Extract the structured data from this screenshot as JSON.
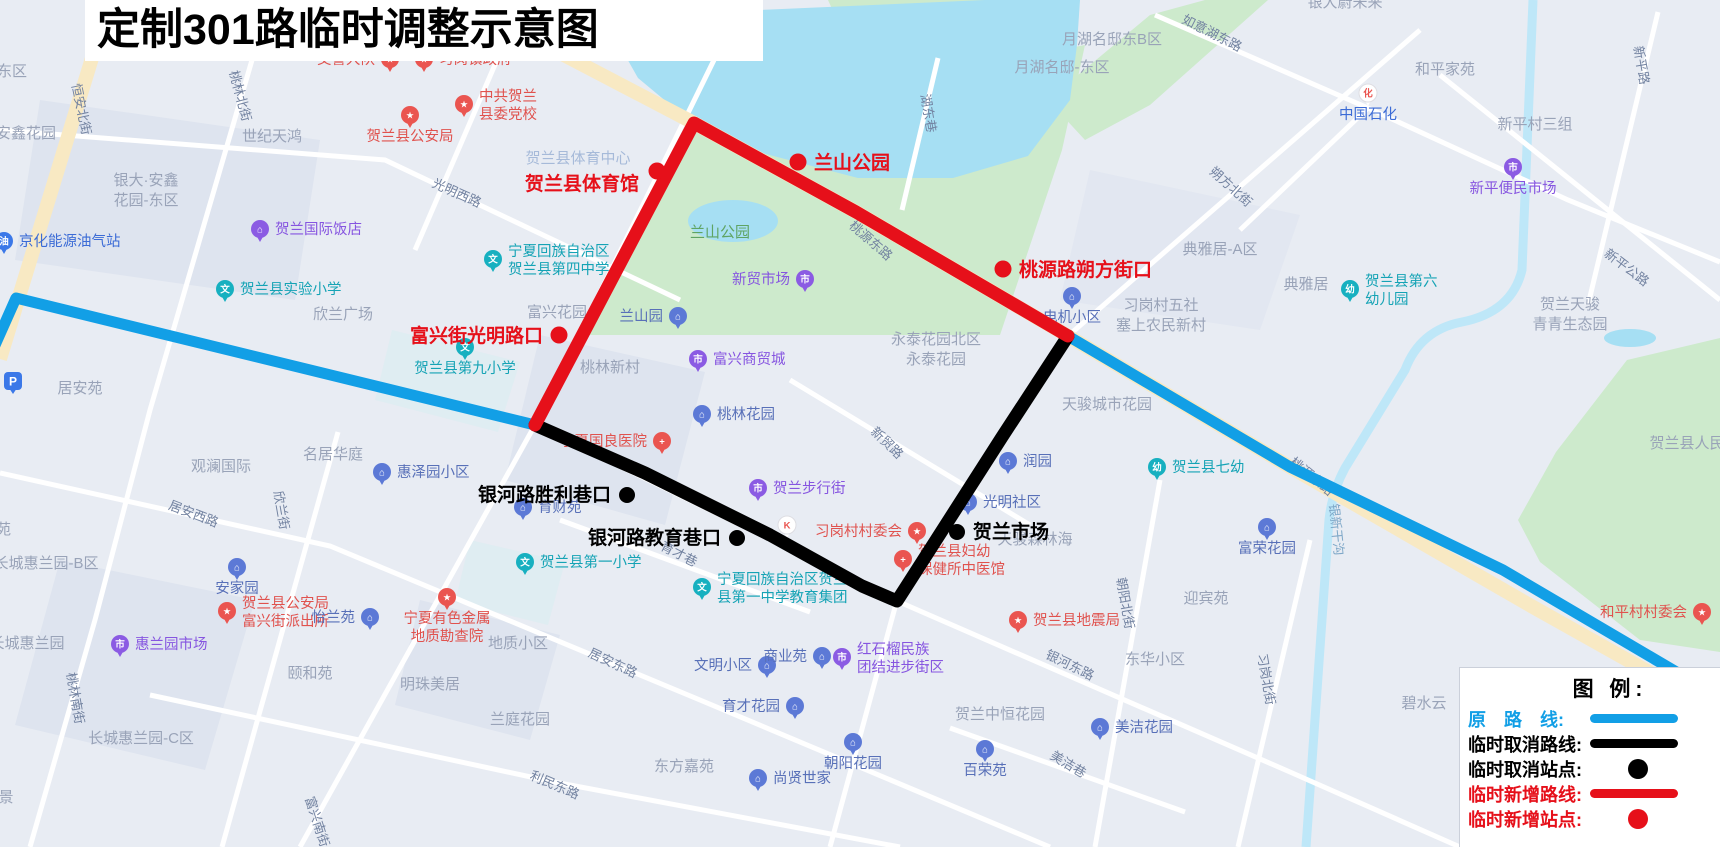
{
  "title": "定制301路临时调整示意图",
  "legend": {
    "title": "图 例:",
    "items": [
      {
        "label": "原　路　线:",
        "color": "#129FE6",
        "sample": "line"
      },
      {
        "label": "临时取消路线:",
        "color": "#000000",
        "sample": "line"
      },
      {
        "label": "临时取消站点:",
        "color": "#000000",
        "sample": "dot"
      },
      {
        "label": "临时新增路线:",
        "color": "#E6101A",
        "sample": "line"
      },
      {
        "label": "临时新增站点:",
        "color": "#E6101A",
        "sample": "dot"
      }
    ]
  },
  "routes": {
    "original": {
      "name": "原路线",
      "color": "#129FE6",
      "width": 11,
      "segments": [
        [
          [
            -8,
            352
          ],
          [
            16,
            298
          ],
          [
            535,
            425
          ]
        ],
        [
          [
            1068,
            336
          ],
          [
            1290,
            467
          ],
          [
            1503,
            570
          ],
          [
            1724,
            700
          ]
        ]
      ]
    },
    "cancelled": {
      "name": "临时取消路线",
      "color": "#000000",
      "width": 13,
      "segments": [
        [
          [
            535,
            425
          ],
          [
            645,
            473
          ],
          [
            770,
            535
          ],
          [
            862,
            586
          ],
          [
            897,
            601
          ],
          [
            922,
            562
          ],
          [
            1002,
            437
          ],
          [
            1068,
            336
          ]
        ]
      ]
    },
    "added": {
      "name": "临时新增路线",
      "color": "#E6101A",
      "width": 13,
      "segments": [
        [
          [
            535,
            425
          ],
          [
            694,
            123
          ],
          [
            856,
            212
          ],
          [
            1068,
            336
          ]
        ]
      ]
    }
  },
  "stations": {
    "added": {
      "color": "#E6101A",
      "dot_r": 8.5,
      "items": [
        {
          "name": "贺兰县体育馆",
          "x": 657,
          "y": 171,
          "side": "left",
          "dx": -2,
          "dy": 13
        },
        {
          "name": "兰山公园",
          "x": 798,
          "y": 162,
          "side": "right",
          "dx": 0,
          "dy": 1
        },
        {
          "name": "桃源路朔方街口",
          "x": 1003,
          "y": 269,
          "side": "right",
          "dx": 0,
          "dy": 1
        },
        {
          "name": "富兴街光明路口",
          "x": 559,
          "y": 335,
          "side": "left",
          "dx": 0,
          "dy": 1
        }
      ]
    },
    "cancelled": {
      "color": "#000000",
      "dot_r": 8,
      "items": [
        {
          "name": "银河路胜利巷口",
          "x": 627,
          "y": 495,
          "side": "left",
          "dx": 0,
          "dy": 0
        },
        {
          "name": "银河路教育巷口",
          "x": 737,
          "y": 538,
          "side": "left",
          "dx": 0,
          "dy": 0
        },
        {
          "name": "贺兰市场",
          "x": 957,
          "y": 532,
          "side": "right",
          "dx": 0,
          "dy": 0
        }
      ]
    }
  },
  "map": {
    "street_labels": [
      {
        "t": "恒安北街",
        "x": 77,
        "y": 110,
        "a": 78
      },
      {
        "t": "桃林北街",
        "x": 236,
        "y": 97,
        "a": 75
      },
      {
        "t": "光明西路",
        "x": 455,
        "y": 197,
        "a": 24
      },
      {
        "t": "湖东巷",
        "x": 924,
        "y": 114,
        "a": 80
      },
      {
        "t": "如意湖东路",
        "x": 1210,
        "y": 37,
        "a": 27
      },
      {
        "t": "朔方北街",
        "x": 1228,
        "y": 190,
        "a": 42
      },
      {
        "t": "新平路",
        "x": 1637,
        "y": 66,
        "a": 80
      },
      {
        "t": "新平公路",
        "x": 1624,
        "y": 271,
        "a": 37
      },
      {
        "t": "桃源东路",
        "x": 868,
        "y": 244,
        "a": 41
      },
      {
        "t": "桃源东路",
        "x": 1309,
        "y": 480,
        "a": 39
      },
      {
        "t": "银新干沟",
        "x": 1332,
        "y": 530,
        "a": 84,
        "c": "water"
      },
      {
        "t": "新贸路",
        "x": 884,
        "y": 446,
        "a": 44
      },
      {
        "t": "育才巷",
        "x": 677,
        "y": 558,
        "a": 27
      },
      {
        "t": "居安西路",
        "x": 192,
        "y": 518,
        "a": 21
      },
      {
        "t": "欣兰街",
        "x": 277,
        "y": 511,
        "a": 80
      },
      {
        "t": "桃林南街",
        "x": 71,
        "y": 699,
        "a": 80
      },
      {
        "t": "居安东路",
        "x": 611,
        "y": 667,
        "a": 25
      },
      {
        "t": "利民东路",
        "x": 553,
        "y": 789,
        "a": 23
      },
      {
        "t": "富兴南街",
        "x": 313,
        "y": 823,
        "a": 72
      },
      {
        "t": "美洁巷",
        "x": 1066,
        "y": 768,
        "a": 31
      },
      {
        "t": "银河东路",
        "x": 1068,
        "y": 669,
        "a": 26
      },
      {
        "t": "朝阳北街",
        "x": 1121,
        "y": 604,
        "a": 80
      },
      {
        "t": "习岗北街",
        "x": 1262,
        "y": 680,
        "a": 80
      }
    ],
    "area_labels": [
      {
        "t": "东区",
        "x": 12,
        "y": 76
      },
      {
        "t": "安鑫花园",
        "x": 26,
        "y": 138
      },
      {
        "t": "世纪天鸿",
        "x": 272,
        "y": 141
      },
      {
        "ls": [
          "银大·安鑫",
          "花园-东区"
        ],
        "x": 146,
        "y": 185
      },
      {
        "t": "月湖名邸东B区",
        "x": 1112,
        "y": 44
      },
      {
        "t": "月湖名邸-东区",
        "x": 1062,
        "y": 72
      },
      {
        "t": "银大蔚未来",
        "x": 1345,
        "y": 7
      },
      {
        "t": "和平家苑",
        "x": 1445,
        "y": 74
      },
      {
        "t": "新平村三组",
        "x": 1535,
        "y": 129
      },
      {
        "t": "典雅居-A区",
        "x": 1220,
        "y": 254
      },
      {
        "t": "典雅居",
        "x": 1306,
        "y": 289
      },
      {
        "ls": [
          "习岗村五社",
          "塞上农民新村"
        ],
        "x": 1161,
        "y": 310
      },
      {
        "ls": [
          "永泰花园北区",
          "永泰花园"
        ],
        "x": 936,
        "y": 344
      },
      {
        "t": "天骏城市花园",
        "x": 1107,
        "y": 409
      },
      {
        "t": "天骏森林海",
        "x": 1035,
        "y": 544
      },
      {
        "ls": [
          "贺兰天骏",
          "青青生态园"
        ],
        "x": 1570,
        "y": 309
      },
      {
        "t": "贺兰县体育中心",
        "x": 578,
        "y": 163,
        "c": "lightblue"
      },
      {
        "t": "兰山公园",
        "x": 720,
        "y": 237,
        "c": "park"
      },
      {
        "t": "富兴花园",
        "x": 557,
        "y": 317
      },
      {
        "t": "欣兰广场",
        "x": 343,
        "y": 319
      },
      {
        "t": "桃林新村",
        "x": 610,
        "y": 372
      },
      {
        "t": "名居华庭",
        "x": 333,
        "y": 459
      },
      {
        "t": "观澜国际",
        "x": 221,
        "y": 471
      },
      {
        "t": "居安苑",
        "x": 80,
        "y": 393
      },
      {
        "t": "福苑",
        "x": -4,
        "y": 534
      },
      {
        "t": "长城惠兰园-B区",
        "x": 46,
        "y": 568
      },
      {
        "t": "长城惠兰园",
        "x": 27,
        "y": 648
      },
      {
        "t": "颐和苑",
        "x": 310,
        "y": 678
      },
      {
        "t": "明珠美居",
        "x": 430,
        "y": 689
      },
      {
        "t": "长城惠兰园-C区",
        "x": 141,
        "y": 743
      },
      {
        "t": "地质小区",
        "x": 518,
        "y": 648
      },
      {
        "t": "兰庭花园",
        "x": 520,
        "y": 724
      },
      {
        "t": "东方嘉苑",
        "x": 684,
        "y": 771
      },
      {
        "t": "迎宾苑",
        "x": 1206,
        "y": 603
      },
      {
        "t": "东华小区",
        "x": 1155,
        "y": 664
      },
      {
        "t": "贺兰中恒花园",
        "x": 1000,
        "y": 719
      },
      {
        "t": "碧水云",
        "x": 1424,
        "y": 708
      },
      {
        "t": "贺兰县人民医院",
        "x": 1702,
        "y": 448
      },
      {
        "t": "景",
        "x": 6,
        "y": 802
      }
    ],
    "icon_colors": {
      "red": "#EA5550",
      "purple": "#8B5BE3",
      "teal": "#17B0C0",
      "blue": "#5C79D6",
      "deepblue": "#3B78E8",
      "white": "#FFFFFF"
    },
    "text_colors": {
      "red": "#E0524E",
      "purple": "#8655E0",
      "teal": "#15A3B5",
      "blue": "#5870B8",
      "deepblue": "#3B6BD6"
    },
    "pois": [
      {
        "t": "交警大队",
        "i": "pin",
        "c": "red",
        "g": "★",
        "x": 390,
        "y": 59,
        "s": "left"
      },
      {
        "t": "习岗镇政府",
        "i": "pin",
        "c": "red",
        "g": "★",
        "x": 424,
        "y": 59,
        "s": "right"
      },
      {
        "t": "贺兰县公安局",
        "i": "pin",
        "c": "red",
        "g": "★",
        "x": 410,
        "y": 115,
        "s": "below"
      },
      {
        "ls": [
          "中共贺兰",
          "县委党校"
        ],
        "i": "pin",
        "c": "red",
        "g": "★",
        "x": 464,
        "y": 104,
        "s": "right"
      },
      {
        "t": "贺兰国际饭店",
        "i": "pin",
        "c": "purple",
        "g": "⌂",
        "x": 260,
        "y": 229,
        "s": "right"
      },
      {
        "t": "京化能源油气站",
        "i": "pin",
        "c": "deepblue",
        "g": "油",
        "x": 4,
        "y": 241,
        "s": "right"
      },
      {
        "t": "贺兰县实验小学",
        "i": "pin",
        "c": "teal",
        "g": "文",
        "x": 225,
        "y": 289,
        "s": "right"
      },
      {
        "ls": [
          "宁夏回族自治区",
          "贺兰县第四中学"
        ],
        "i": "pin",
        "c": "teal",
        "g": "文",
        "x": 493,
        "y": 259,
        "s": "right"
      },
      {
        "t": "贺兰县第九小学",
        "i": "pin",
        "c": "teal",
        "g": "文",
        "x": 465,
        "y": 347,
        "s": "below"
      },
      {
        "t": "新贸市场",
        "i": "pin",
        "c": "purple",
        "g": "市",
        "x": 805,
        "y": 279,
        "s": "left"
      },
      {
        "t": "兰山园",
        "i": "pin",
        "c": "blue",
        "g": "⌂",
        "x": 678,
        "y": 316,
        "s": "left"
      },
      {
        "t": "富兴商贸城",
        "i": "pin",
        "c": "purple",
        "g": "市",
        "x": 698,
        "y": 359,
        "s": "right"
      },
      {
        "t": "桃林花园",
        "i": "pin",
        "c": "blue",
        "g": "⌂",
        "x": 702,
        "y": 414,
        "s": "right"
      },
      {
        "t": "电机小区",
        "i": "pin",
        "c": "blue",
        "g": "⌂",
        "x": 1072,
        "y": 296,
        "s": "below"
      },
      {
        "ls": [
          "贺兰县第六",
          "幼儿园"
        ],
        "i": "pin",
        "c": "teal",
        "g": "幼",
        "x": 1350,
        "y": 289,
        "s": "right"
      },
      {
        "t": "贺兰县七幼",
        "i": "pin",
        "c": "teal",
        "g": "幼",
        "x": 1157,
        "y": 467,
        "s": "right"
      },
      {
        "t": "润园",
        "i": "pin",
        "c": "blue",
        "g": "⌂",
        "x": 1008,
        "y": 461,
        "s": "right"
      },
      {
        "t": "光明社区",
        "i": "pin",
        "c": "blue",
        "g": "⌂",
        "x": 968,
        "y": 502,
        "s": "right"
      },
      {
        "t": "富荣花园",
        "i": "pin",
        "c": "blue",
        "g": "⌂",
        "x": 1267,
        "y": 527,
        "s": "below"
      },
      {
        "t": "宁夏国良医院",
        "i": "pin",
        "c": "red",
        "g": "+",
        "x": 662,
        "y": 441,
        "s": "left"
      },
      {
        "t": "贺兰步行街",
        "i": "pin",
        "c": "purple",
        "g": "市",
        "x": 758,
        "y": 488,
        "s": "right"
      },
      {
        "t": "育财苑",
        "i": "pin",
        "c": "blue",
        "g": "⌂",
        "x": 523,
        "y": 507,
        "s": "right"
      },
      {
        "t": "惠泽园小区",
        "i": "pin",
        "c": "blue",
        "g": "⌂",
        "x": 382,
        "y": 472,
        "s": "right"
      },
      {
        "t": "安家园",
        "i": "pin",
        "c": "blue",
        "g": "⌂",
        "x": 237,
        "y": 567,
        "s": "below"
      },
      {
        "ls": [
          "贺兰县公安局",
          "富兴街派出所"
        ],
        "i": "pin",
        "c": "red",
        "g": "★",
        "x": 227,
        "y": 611,
        "s": "right"
      },
      {
        "t": "怡兰苑",
        "i": "pin",
        "c": "blue",
        "g": "⌂",
        "x": 370,
        "y": 617,
        "s": "left"
      },
      {
        "t": "惠兰园市场",
        "i": "pin",
        "c": "purple",
        "g": "市",
        "x": 120,
        "y": 644,
        "s": "right"
      },
      {
        "ls": [
          "宁夏有色金属",
          "地质勘查院"
        ],
        "i": "pin",
        "c": "red",
        "g": "★",
        "x": 447,
        "y": 597,
        "s": "below"
      },
      {
        "t": "贺兰县第一小学",
        "i": "pin",
        "c": "teal",
        "g": "文",
        "x": 525,
        "y": 562,
        "s": "right"
      },
      {
        "ls": [
          "宁夏回族自治区贺兰",
          "县第一中学教育集团"
        ],
        "i": "pin",
        "c": "teal",
        "g": "文",
        "x": 702,
        "y": 587,
        "s": "right"
      },
      {
        "t": "文明小区",
        "i": "pin",
        "c": "blue",
        "g": "⌂",
        "x": 767,
        "y": 665,
        "s": "left"
      },
      {
        "t": "商业苑",
        "i": "pin",
        "c": "blue",
        "g": "⌂",
        "x": 822,
        "y": 656,
        "s": "left"
      },
      {
        "ls": [
          "红石榴民族",
          "团结进步街区"
        ],
        "i": "pin",
        "c": "purple",
        "g": "市",
        "x": 842,
        "y": 657,
        "s": "right"
      },
      {
        "t": "育才花园",
        "i": "pin",
        "c": "blue",
        "g": "⌂",
        "x": 795,
        "y": 706,
        "s": "left"
      },
      {
        "t": "尚贤世家",
        "i": "pin",
        "c": "blue",
        "g": "⌂",
        "x": 758,
        "y": 778,
        "s": "right"
      },
      {
        "t": "朝阳花园",
        "i": "pin",
        "c": "blue",
        "g": "⌂",
        "x": 853,
        "y": 742,
        "s": "below"
      },
      {
        "t": "百荣苑",
        "i": "pin",
        "c": "blue",
        "g": "⌂",
        "x": 985,
        "y": 749,
        "s": "below"
      },
      {
        "t": "美洁花园",
        "i": "pin",
        "c": "blue",
        "g": "⌂",
        "x": 1100,
        "y": 727,
        "s": "right"
      },
      {
        "t": "贺兰县地震局",
        "i": "pin",
        "c": "red",
        "g": "★",
        "x": 1018,
        "y": 620,
        "s": "right"
      },
      {
        "t": "习岗村村委会",
        "i": "pin",
        "c": "red",
        "g": "★",
        "x": 917,
        "y": 531,
        "s": "left"
      },
      {
        "ls": [
          "贺兰县妇幼",
          "保健所中医馆"
        ],
        "i": "pin",
        "c": "red",
        "g": "+",
        "x": 903,
        "y": 559,
        "s": "right"
      },
      {
        "t": "",
        "i": "pin-light",
        "c": "white",
        "g": "K",
        "gc": "red",
        "x": 787,
        "y": 525,
        "s": "none"
      },
      {
        "t": "中国石化",
        "i": "pin-light",
        "c": "white",
        "g": "化",
        "gc": "red",
        "x": 1368,
        "y": 93,
        "s": "below",
        "tc": "deepblue"
      },
      {
        "t": "新平便民市场",
        "i": "pin",
        "c": "purple",
        "g": "市",
        "x": 1513,
        "y": 167,
        "s": "below"
      },
      {
        "t": "和平村村委会",
        "i": "pin",
        "c": "red",
        "g": "★",
        "x": 1702,
        "y": 612,
        "s": "left"
      },
      {
        "t": "",
        "i": "square",
        "c": "deepblue",
        "g": "P",
        "x": 13,
        "y": 381,
        "s": "none"
      }
    ]
  }
}
